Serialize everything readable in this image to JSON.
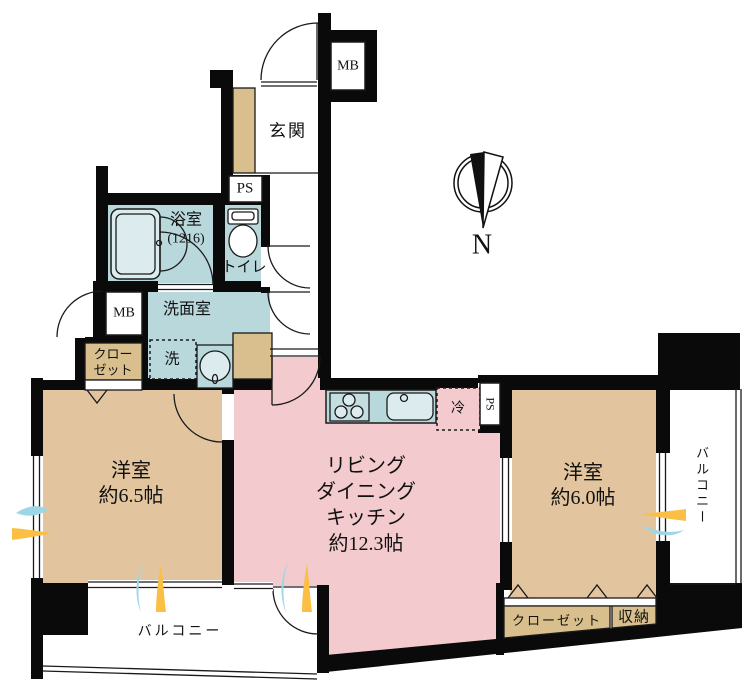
{
  "labels": {
    "entrance": "玄関",
    "meter_box": "MB",
    "pipe_space": "PS",
    "bathroom": "浴室",
    "bathroom_size": "(1216)",
    "toilet": "トイレ",
    "washroom": "洗面室",
    "laundry": "洗",
    "closet": "クローゼット",
    "bedroom": "洋室",
    "bedroom1_size": "約6.5帖",
    "bedroom2_size": "約6.0帖",
    "ldk_line1": "リビング",
    "ldk_line2": "ダイニング",
    "ldk_line3": "キッチン",
    "ldk_size": "約12.3帖",
    "balcony": "バルコニー",
    "storage": "収納",
    "fridge": "冷",
    "north": "N"
  },
  "colors": {
    "wall": "#0a0a0a",
    "wet": "#b9d8dc",
    "room": "#e2c59f",
    "closet": "#d8bf8d",
    "ldk": "#f3cacd",
    "fixture": "#dcecee",
    "swoosh_blue": "#9fd6e6",
    "swoosh_yellow": "#fcbf45"
  }
}
